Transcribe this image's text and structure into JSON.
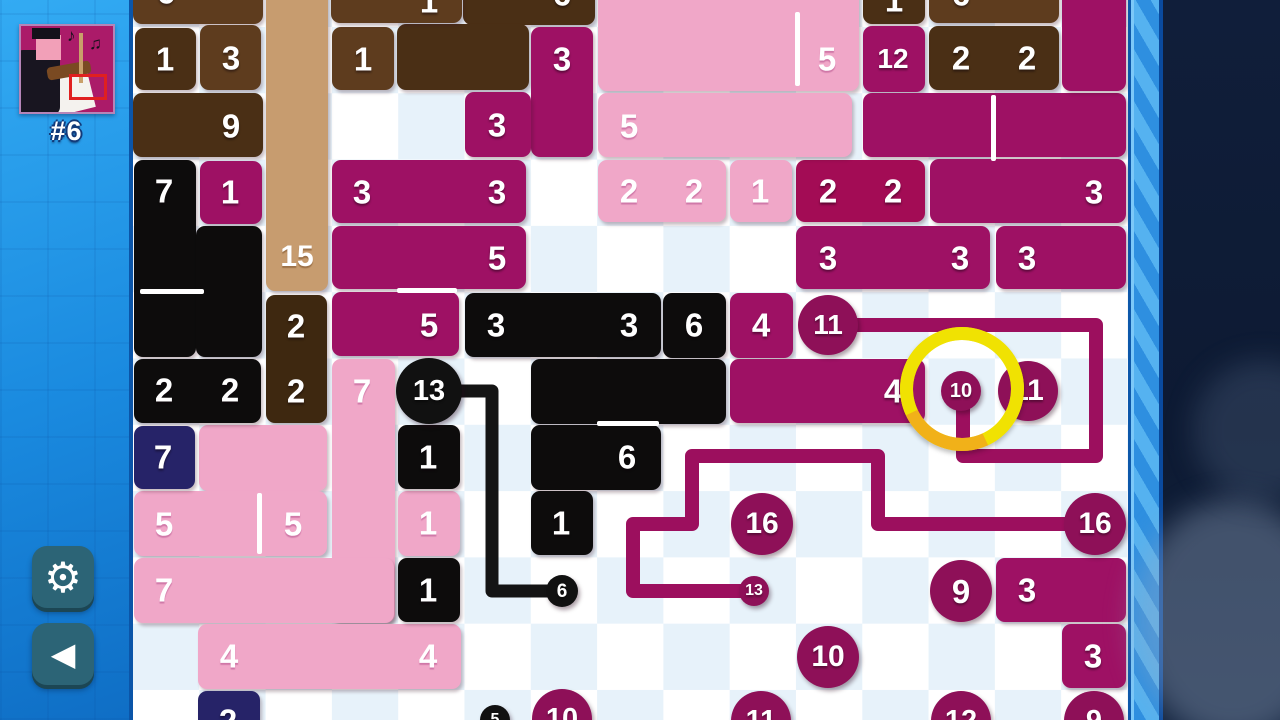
{
  "sidebar": {
    "level_label": "#6",
    "settings_icon": "⚙",
    "back_icon": "◀",
    "avatar_notes": [
      "♪",
      "♫"
    ]
  },
  "palette": {
    "magenta": "#9E1164",
    "crimson": "#A30C55",
    "pink": "#F0A7C8",
    "black": "#0D0C0C",
    "navy": "#262368",
    "brownDark": "#4A2F15",
    "brownMid": "#5E3C1E",
    "brownDeep": "#3E2810",
    "tan": "#C79C6F",
    "circleMagenta": "#8E1058",
    "circleBlack": "#111111",
    "lineMagenta": "#9C0F5E",
    "lineBlack": "#141414",
    "cursorYellow": "#F0E202",
    "cursorOrange": "#F2A51F"
  },
  "board": {
    "pieces": [
      {
        "c": "brownMid",
        "x": 133,
        "y": -39,
        "w": 130,
        "h": 63,
        "L": [
          {
            "t": "6",
            "x": 166,
            "y": -8
          }
        ]
      },
      {
        "c": "brownDark",
        "x": 135,
        "y": 28,
        "w": 61,
        "h": 62,
        "L": [
          {
            "t": "1",
            "x": 165,
            "y": 59
          }
        ]
      },
      {
        "c": "brownMid",
        "x": 200,
        "y": 25,
        "w": 61,
        "h": 65,
        "L": [
          {
            "t": "3",
            "x": 231,
            "y": 58
          }
        ]
      },
      {
        "c": "brownDark",
        "x": 133,
        "y": 93,
        "w": 130,
        "h": 64,
        "L": [
          {
            "t": "9",
            "x": 231,
            "y": 126
          }
        ]
      },
      {
        "c": "tan",
        "x": 266,
        "y": -39,
        "w": 62,
        "h": 330,
        "L": [
          {
            "t": "15",
            "x": 297,
            "y": 257,
            "s": 30
          }
        ]
      },
      {
        "c": "brownDeep",
        "x": 266,
        "y": 295,
        "w": 61,
        "h": 128,
        "L": [
          {
            "t": "2",
            "x": 296,
            "y": 326
          },
          {
            "t": "2",
            "x": 296,
            "y": 391
          }
        ]
      },
      {
        "c": "brownMid",
        "x": 332,
        "y": 27,
        "w": 62,
        "h": 63,
        "L": [
          {
            "t": "1",
            "x": 363,
            "y": 59
          }
        ]
      },
      {
        "c": "brownDark",
        "x": 463,
        "y": -39,
        "w": 132,
        "h": 64,
        "L": [
          {
            "t": "6",
            "x": 562,
            "y": -6
          }
        ]
      },
      {
        "c": "brownDark",
        "x": 397,
        "y": 24,
        "w": 132,
        "h": 66,
        "L": []
      },
      {
        "c": "brownMid",
        "x": 331,
        "y": -39,
        "w": 131,
        "h": 62,
        "L": [
          {
            "t": "1",
            "x": 429,
            "y": 1
          }
        ]
      },
      {
        "c": "brownMid",
        "x": 664,
        "y": -39,
        "w": 62,
        "h": 62,
        "L": [
          {
            "t": "1",
            "x": 695,
            "y": 0
          }
        ]
      },
      {
        "c": "brownDark",
        "x": 863,
        "y": -39,
        "w": 62,
        "h": 63,
        "L": [
          {
            "t": "1",
            "x": 894,
            "y": 0
          }
        ]
      },
      {
        "c": "brownMid",
        "x": 929,
        "y": -39,
        "w": 130,
        "h": 62,
        "L": [
          {
            "t": "6",
            "x": 961,
            "y": -6
          }
        ]
      },
      {
        "c": "brownDark",
        "x": 929,
        "y": 26,
        "w": 130,
        "h": 64,
        "L": [
          {
            "t": "2",
            "x": 961,
            "y": 58
          },
          {
            "t": "2",
            "x": 1027,
            "y": 58
          }
        ]
      },
      {
        "c": "magenta",
        "x": 531,
        "y": 27,
        "w": 62,
        "h": 130,
        "L": [
          {
            "t": "3",
            "x": 562,
            "y": 59
          }
        ]
      },
      {
        "c": "magenta",
        "x": 465,
        "y": 92,
        "w": 66,
        "h": 65,
        "L": [
          {
            "t": "3",
            "x": 497,
            "y": 125
          }
        ]
      },
      {
        "c": "magenta",
        "x": 863,
        "y": 26,
        "w": 62,
        "h": 66,
        "L": [
          {
            "t": "12",
            "x": 893,
            "y": 59,
            "s": 28
          }
        ]
      },
      {
        "c": "magenta",
        "x": 863,
        "y": 93,
        "w": 263,
        "h": 64,
        "L": []
      },
      {
        "c": "magenta",
        "x": 1062,
        "y": -39,
        "w": 64,
        "h": 130,
        "L": []
      },
      {
        "c": "magenta",
        "x": 930,
        "y": 159,
        "w": 196,
        "h": 64,
        "L": [
          {
            "t": "3",
            "x": 1094,
            "y": 192
          }
        ]
      },
      {
        "c": "magenta",
        "x": 332,
        "y": 160,
        "w": 194,
        "h": 63,
        "L": [
          {
            "t": "3",
            "x": 362,
            "y": 192
          },
          {
            "t": "3",
            "x": 497,
            "y": 192
          }
        ]
      },
      {
        "c": "magenta",
        "x": 332,
        "y": 226,
        "w": 194,
        "h": 63,
        "L": [
          {
            "t": "5",
            "x": 497,
            "y": 258
          }
        ]
      },
      {
        "c": "magenta",
        "x": 332,
        "y": 292,
        "w": 127,
        "h": 64,
        "L": [
          {
            "t": "5",
            "x": 429,
            "y": 325
          }
        ]
      },
      {
        "c": "magenta",
        "x": 200,
        "y": 161,
        "w": 62,
        "h": 63,
        "L": [
          {
            "t": "1",
            "x": 230,
            "y": 192
          }
        ]
      },
      {
        "c": "magenta",
        "x": 730,
        "y": 293,
        "w": 63,
        "h": 65,
        "L": [
          {
            "t": "4",
            "x": 761,
            "y": 325
          }
        ]
      },
      {
        "c": "magenta",
        "x": 730,
        "y": 359,
        "w": 195,
        "h": 64,
        "L": [
          {
            "t": "4",
            "x": 893,
            "y": 391
          }
        ]
      },
      {
        "c": "crimson",
        "x": 796,
        "y": 160,
        "w": 129,
        "h": 62,
        "L": [
          {
            "t": "2",
            "x": 828,
            "y": 191
          },
          {
            "t": "2",
            "x": 893,
            "y": 191
          }
        ]
      },
      {
        "c": "magenta",
        "x": 796,
        "y": 226,
        "w": 194,
        "h": 63,
        "L": [
          {
            "t": "3",
            "x": 828,
            "y": 258
          },
          {
            "t": "3",
            "x": 960,
            "y": 258
          }
        ]
      },
      {
        "c": "magenta",
        "x": 996,
        "y": 226,
        "w": 130,
        "h": 63,
        "L": [
          {
            "t": "3",
            "x": 1027,
            "y": 258
          }
        ]
      },
      {
        "c": "magenta",
        "x": 996,
        "y": 558,
        "w": 130,
        "h": 64,
        "L": [
          {
            "t": "3",
            "x": 1027,
            "y": 590
          }
        ]
      },
      {
        "c": "magenta",
        "x": 1062,
        "y": 624,
        "w": 64,
        "h": 64,
        "L": [
          {
            "t": "3",
            "x": 1093,
            "y": 656
          }
        ]
      },
      {
        "c": "pink",
        "x": 598,
        "y": -39,
        "w": 261,
        "h": 130,
        "L": [
          {
            "t": "5",
            "x": 827,
            "y": 59
          }
        ]
      },
      {
        "c": "pink",
        "x": 598,
        "y": 93,
        "w": 254,
        "h": 64,
        "L": [
          {
            "t": "5",
            "x": 629,
            "y": 126
          }
        ]
      },
      {
        "c": "pink",
        "x": 598,
        "y": 160,
        "w": 128,
        "h": 62,
        "L": [
          {
            "t": "2",
            "x": 629,
            "y": 191
          },
          {
            "t": "2",
            "x": 694,
            "y": 191
          }
        ]
      },
      {
        "c": "pink",
        "x": 730,
        "y": 160,
        "w": 62,
        "h": 62,
        "L": [
          {
            "t": "1",
            "x": 760,
            "y": 191
          }
        ]
      },
      {
        "c": "pink",
        "x": 199,
        "y": 425,
        "w": 128,
        "h": 66,
        "L": []
      },
      {
        "c": "pink",
        "x": 134,
        "y": 491,
        "w": 193,
        "h": 65,
        "L": [
          {
            "t": "5",
            "x": 164,
            "y": 524
          },
          {
            "t": "5",
            "x": 293,
            "y": 524
          }
        ]
      },
      {
        "c": "pink",
        "x": 332,
        "y": 359,
        "w": 63,
        "h": 264,
        "L": [
          {
            "t": "7",
            "x": 362,
            "y": 391
          }
        ]
      },
      {
        "c": "pink",
        "x": 134,
        "y": 558,
        "w": 260,
        "h": 65,
        "L": [
          {
            "t": "7",
            "x": 164,
            "y": 590
          }
        ]
      },
      {
        "c": "pink",
        "x": 198,
        "y": 624,
        "w": 263,
        "h": 65,
        "L": [
          {
            "t": "4",
            "x": 229,
            "y": 656
          },
          {
            "t": "4",
            "x": 428,
            "y": 656
          }
        ]
      },
      {
        "c": "pink",
        "x": 398,
        "y": 491,
        "w": 62,
        "h": 65,
        "L": [
          {
            "t": "1",
            "x": 428,
            "y": 523
          }
        ]
      },
      {
        "c": "black",
        "x": 134,
        "y": 160,
        "w": 62,
        "h": 197,
        "L": [
          {
            "t": "7",
            "x": 164,
            "y": 191
          }
        ]
      },
      {
        "c": "black",
        "x": 196,
        "y": 226,
        "w": 66,
        "h": 131,
        "L": []
      },
      {
        "c": "black",
        "x": 134,
        "y": 359,
        "w": 127,
        "h": 64,
        "L": [
          {
            "t": "2",
            "x": 164,
            "y": 390
          },
          {
            "t": "2",
            "x": 230,
            "y": 390
          }
        ]
      },
      {
        "c": "black",
        "x": 465,
        "y": 293,
        "w": 196,
        "h": 64,
        "L": [
          {
            "t": "3",
            "x": 496,
            "y": 325
          },
          {
            "t": "3",
            "x": 629,
            "y": 325
          }
        ]
      },
      {
        "c": "black",
        "x": 663,
        "y": 293,
        "w": 63,
        "h": 65,
        "L": [
          {
            "t": "6",
            "x": 694,
            "y": 325
          }
        ]
      },
      {
        "c": "black",
        "x": 531,
        "y": 359,
        "w": 195,
        "h": 65,
        "L": []
      },
      {
        "c": "black",
        "x": 531,
        "y": 425,
        "w": 130,
        "h": 65,
        "L": [
          {
            "t": "6",
            "x": 627,
            "y": 457
          }
        ]
      },
      {
        "c": "black",
        "x": 398,
        "y": 425,
        "w": 62,
        "h": 64,
        "L": [
          {
            "t": "1",
            "x": 428,
            "y": 457
          }
        ]
      },
      {
        "c": "black",
        "x": 398,
        "y": 558,
        "w": 62,
        "h": 64,
        "L": [
          {
            "t": "1",
            "x": 428,
            "y": 590
          }
        ]
      },
      {
        "c": "black",
        "x": 531,
        "y": 491,
        "w": 62,
        "h": 64,
        "L": [
          {
            "t": "1",
            "x": 561,
            "y": 523
          }
        ]
      },
      {
        "c": "navy",
        "x": 134,
        "y": 426,
        "w": 61,
        "h": 63,
        "L": [
          {
            "t": "7",
            "x": 163,
            "y": 457
          }
        ]
      },
      {
        "c": "navy",
        "x": 198,
        "y": 691,
        "w": 62,
        "h": 40,
        "L": [
          {
            "t": "2",
            "x": 228,
            "y": 721
          }
        ]
      }
    ],
    "seams": [
      {
        "x": 795,
        "y": 12,
        "w": 5,
        "h": 74
      },
      {
        "x": 140,
        "y": 289,
        "w": 64,
        "h": 5
      },
      {
        "x": 397,
        "y": 288,
        "w": 60,
        "h": 5
      },
      {
        "x": 991,
        "y": 95,
        "w": 5,
        "h": 66
      },
      {
        "x": 257,
        "y": 493,
        "w": 5,
        "h": 61
      },
      {
        "x": 597,
        "y": 421,
        "w": 62,
        "h": 5
      }
    ],
    "lines": [
      {
        "c": "lineMagenta",
        "w": 14,
        "pts": [
          [
            846,
            325
          ],
          [
            1096,
            325
          ],
          [
            1096,
            456
          ],
          [
            963,
            456
          ],
          [
            963,
            398
          ]
        ]
      },
      {
        "c": "lineMagenta",
        "w": 14,
        "pts": [
          [
            1086,
            524
          ],
          [
            878,
            524
          ],
          [
            878,
            456
          ],
          [
            692,
            456
          ],
          [
            692,
            524
          ],
          [
            633,
            524
          ],
          [
            633,
            591
          ],
          [
            744,
            591
          ]
        ]
      },
      {
        "c": "lineBlack",
        "w": 13,
        "pts": [
          [
            440,
            391
          ],
          [
            492,
            391
          ],
          [
            492,
            591
          ],
          [
            547,
            591
          ]
        ]
      }
    ],
    "circles": [
      {
        "cx": 429,
        "cy": 391,
        "r": 33,
        "c": "circleBlack",
        "t": "13",
        "s": 29
      },
      {
        "cx": 562,
        "cy": 591,
        "r": 16,
        "c": "circleBlack",
        "t": "6",
        "s": 19
      },
      {
        "cx": 828,
        "cy": 325,
        "r": 30,
        "c": "circleMagenta",
        "t": "11",
        "s": 28
      },
      {
        "cx": 961,
        "cy": 391,
        "r": 20,
        "c": "circleMagenta",
        "t": "10",
        "s": 20
      },
      {
        "cx": 1028,
        "cy": 391,
        "r": 30,
        "c": "circleMagenta",
        "t": "11",
        "s": 30
      },
      {
        "cx": 762,
        "cy": 524,
        "r": 31,
        "c": "circleMagenta",
        "t": "16",
        "s": 30
      },
      {
        "cx": 1095,
        "cy": 524,
        "r": 31,
        "c": "circleMagenta",
        "t": "16",
        "s": 30
      },
      {
        "cx": 754,
        "cy": 591,
        "r": 15,
        "c": "circleMagenta",
        "t": "13",
        "s": 16
      },
      {
        "cx": 961,
        "cy": 591,
        "r": 31,
        "c": "circleMagenta",
        "t": "9",
        "s": 33
      },
      {
        "cx": 828,
        "cy": 657,
        "r": 31,
        "c": "circleMagenta",
        "t": "10",
        "s": 30
      },
      {
        "cx": 495,
        "cy": 720,
        "r": 15,
        "c": "circleBlack",
        "t": "5",
        "s": 16
      },
      {
        "cx": 562,
        "cy": 719,
        "r": 30,
        "c": "circleMagenta",
        "t": "10",
        "s": 29
      },
      {
        "cx": 761,
        "cy": 721,
        "r": 30,
        "c": "circleMagenta",
        "t": "11",
        "s": 29
      },
      {
        "cx": 961,
        "cy": 721,
        "r": 30,
        "c": "circleMagenta",
        "t": "12",
        "s": 29
      },
      {
        "cx": 1094,
        "cy": 721,
        "r": 30,
        "c": "circleMagenta",
        "t": "9",
        "s": 29
      }
    ],
    "cursor": {
      "cx": 962,
      "cy": 389,
      "r": 62,
      "stroke": 13
    }
  }
}
